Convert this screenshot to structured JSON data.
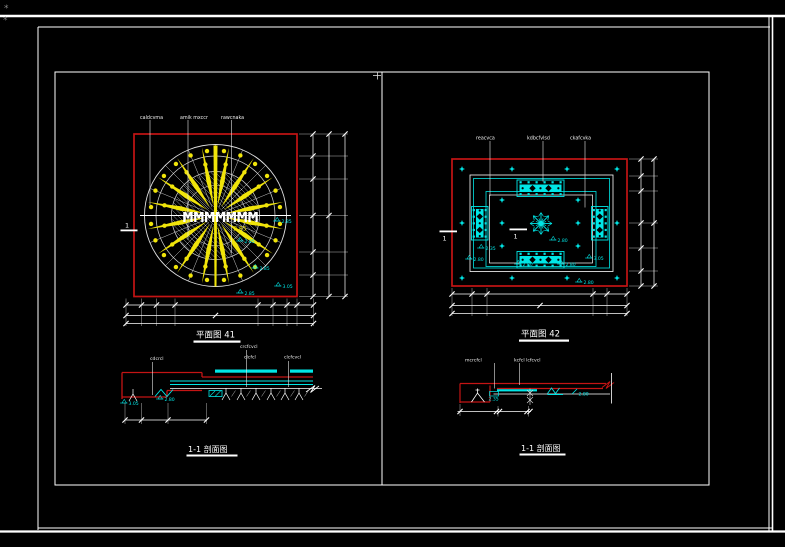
{
  "page": {
    "corner_mark": "*"
  },
  "colors": {
    "background": "#000000",
    "white": "#ffffff",
    "red": "#c41414",
    "yellow": "#f0e40a",
    "cyan": "#00e6e6",
    "hatch": "#b9c2cb",
    "dim_gray": "#c9c9c9"
  },
  "plan_a": {
    "title": "平面图 41",
    "callouts": [
      "caldcvma",
      "amik mxccr",
      "rawcnaka"
    ],
    "center_text": "MMMMMMM",
    "center_note": "2.85",
    "cut_marker": "1",
    "elevations": [
      "2.85",
      "2.85",
      "2.85",
      "3.05",
      "2.85"
    ]
  },
  "plan_b": {
    "title": "平面图 42",
    "callouts": [
      "reacvca",
      "kdbcfvlsd",
      "ckafcvka"
    ],
    "cut_markers": [
      "1",
      "1"
    ],
    "elevations": [
      "2.80",
      "2.35",
      "2.80",
      "2.80",
      "2.80",
      "3.05",
      "2.80"
    ]
  },
  "section_a": {
    "title": "1-1 剖面图",
    "callouts": [
      "cdcrcl",
      "crcfcvcl",
      "clcfcl",
      "clcfcvcl"
    ],
    "elevations": [
      "2.80",
      "3.05"
    ]
  },
  "section_b": {
    "title": "1-1 剖面图",
    "callouts": [
      "mcrcfcl",
      "kcfcl lcfcvcl"
    ],
    "elevations": [
      "2.35",
      "2.80"
    ]
  }
}
